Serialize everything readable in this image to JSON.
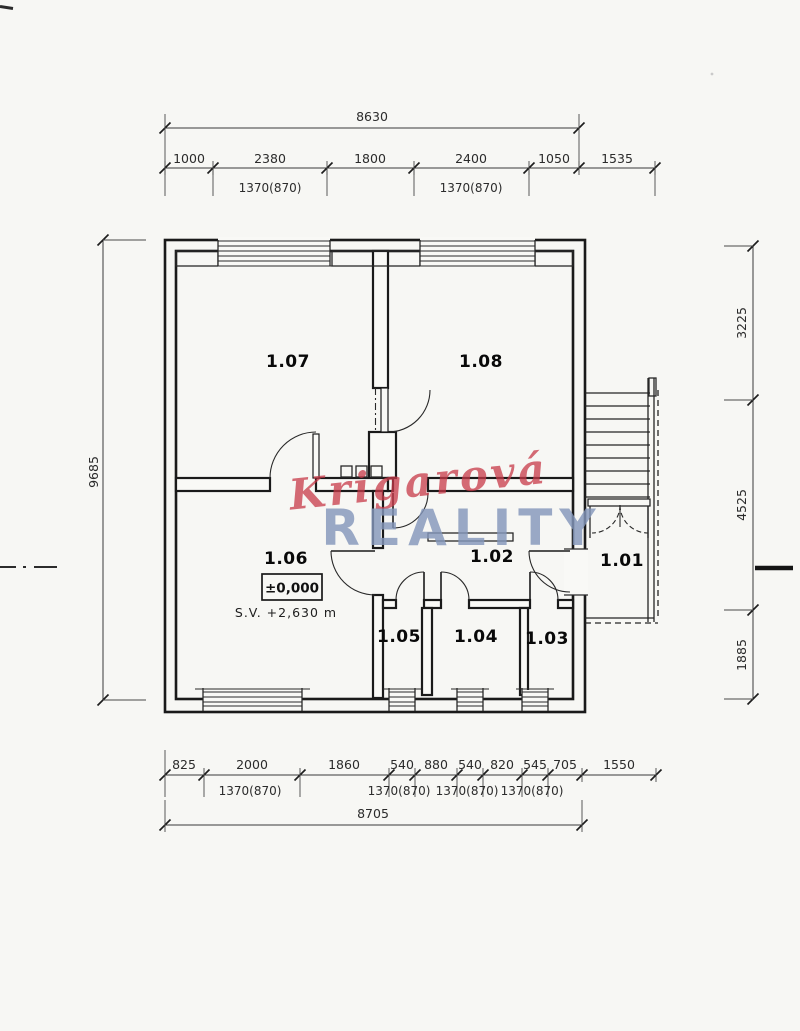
{
  "page": {
    "background": "#f7f7f4"
  },
  "watermark": {
    "script": "Krigarová",
    "block": "REALITY",
    "script_color": "rgba(198,59,74,0.75)",
    "block_color": "rgba(132,150,186,0.82)"
  },
  "rooms": [
    {
      "id": "1.07"
    },
    {
      "id": "1.08"
    },
    {
      "id": "1.06"
    },
    {
      "id": "1.02"
    },
    {
      "id": "1.05"
    },
    {
      "id": "1.04"
    },
    {
      "id": "1.03"
    },
    {
      "id": "1.01"
    }
  ],
  "annotations": {
    "level": "±0,000",
    "clearance": "S.V. +2,630 m"
  },
  "dims": {
    "top": {
      "total": "8630",
      "segments": [
        "1000",
        "2380",
        "1800",
        "2400",
        "1050",
        "1535"
      ],
      "sub": [
        "1370(870)",
        "1370(870)"
      ]
    },
    "left": {
      "total": "9685"
    },
    "right": {
      "segments": [
        "3225",
        "4525",
        "1885"
      ]
    },
    "bottom": {
      "segments": [
        "825",
        "2000",
        "1860",
        "540",
        "880",
        "540",
        "820",
        "545",
        "705",
        "1550"
      ],
      "sub": [
        "1370(870)",
        "1370(870)",
        "1370(870)",
        "1370(870)"
      ],
      "total": "8705"
    }
  }
}
